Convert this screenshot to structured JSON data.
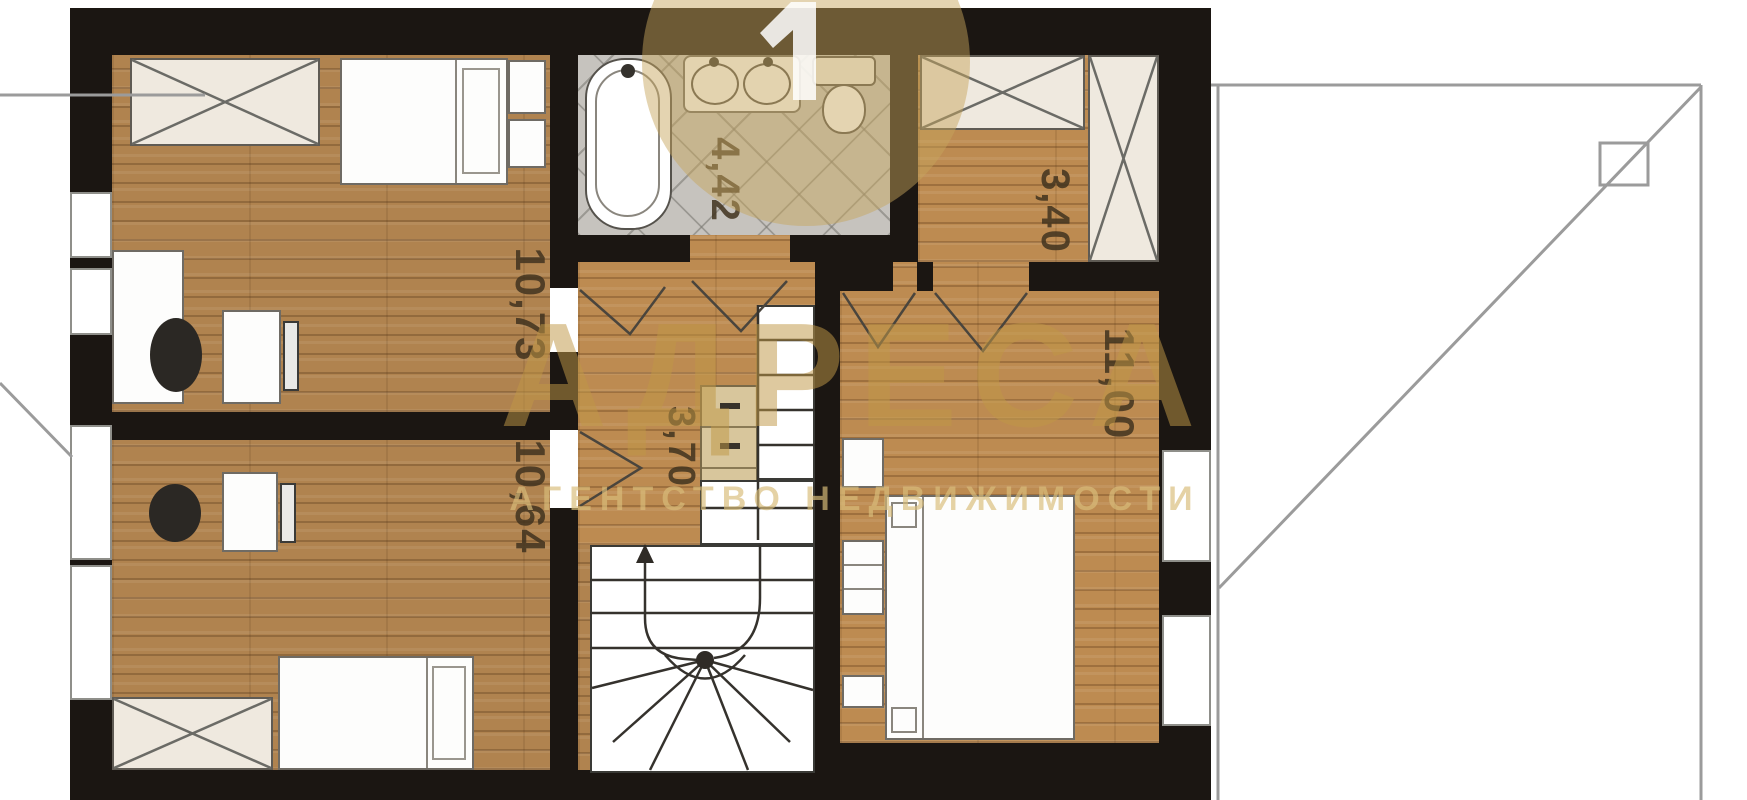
{
  "meta": {
    "type": "floor-plan"
  },
  "dims": {
    "top_left_room": "10,73",
    "bottom_left_room": "10,64",
    "bathroom": "4,42",
    "hallway": "3,70",
    "closet": "3,40",
    "right_room": "11,00"
  },
  "watermark": {
    "title": "АДРЕСА",
    "subtitle": "АГЕНТСТВО НЕДВИЖИМОСТИ",
    "color": "#c5a05c"
  },
  "colors": {
    "wall": "#1b1612",
    "wood_floor": "#b0834f",
    "tile_floor": "#c6c3be",
    "roof_line": "#9b9b9b",
    "watermark": "#c5a05c"
  }
}
